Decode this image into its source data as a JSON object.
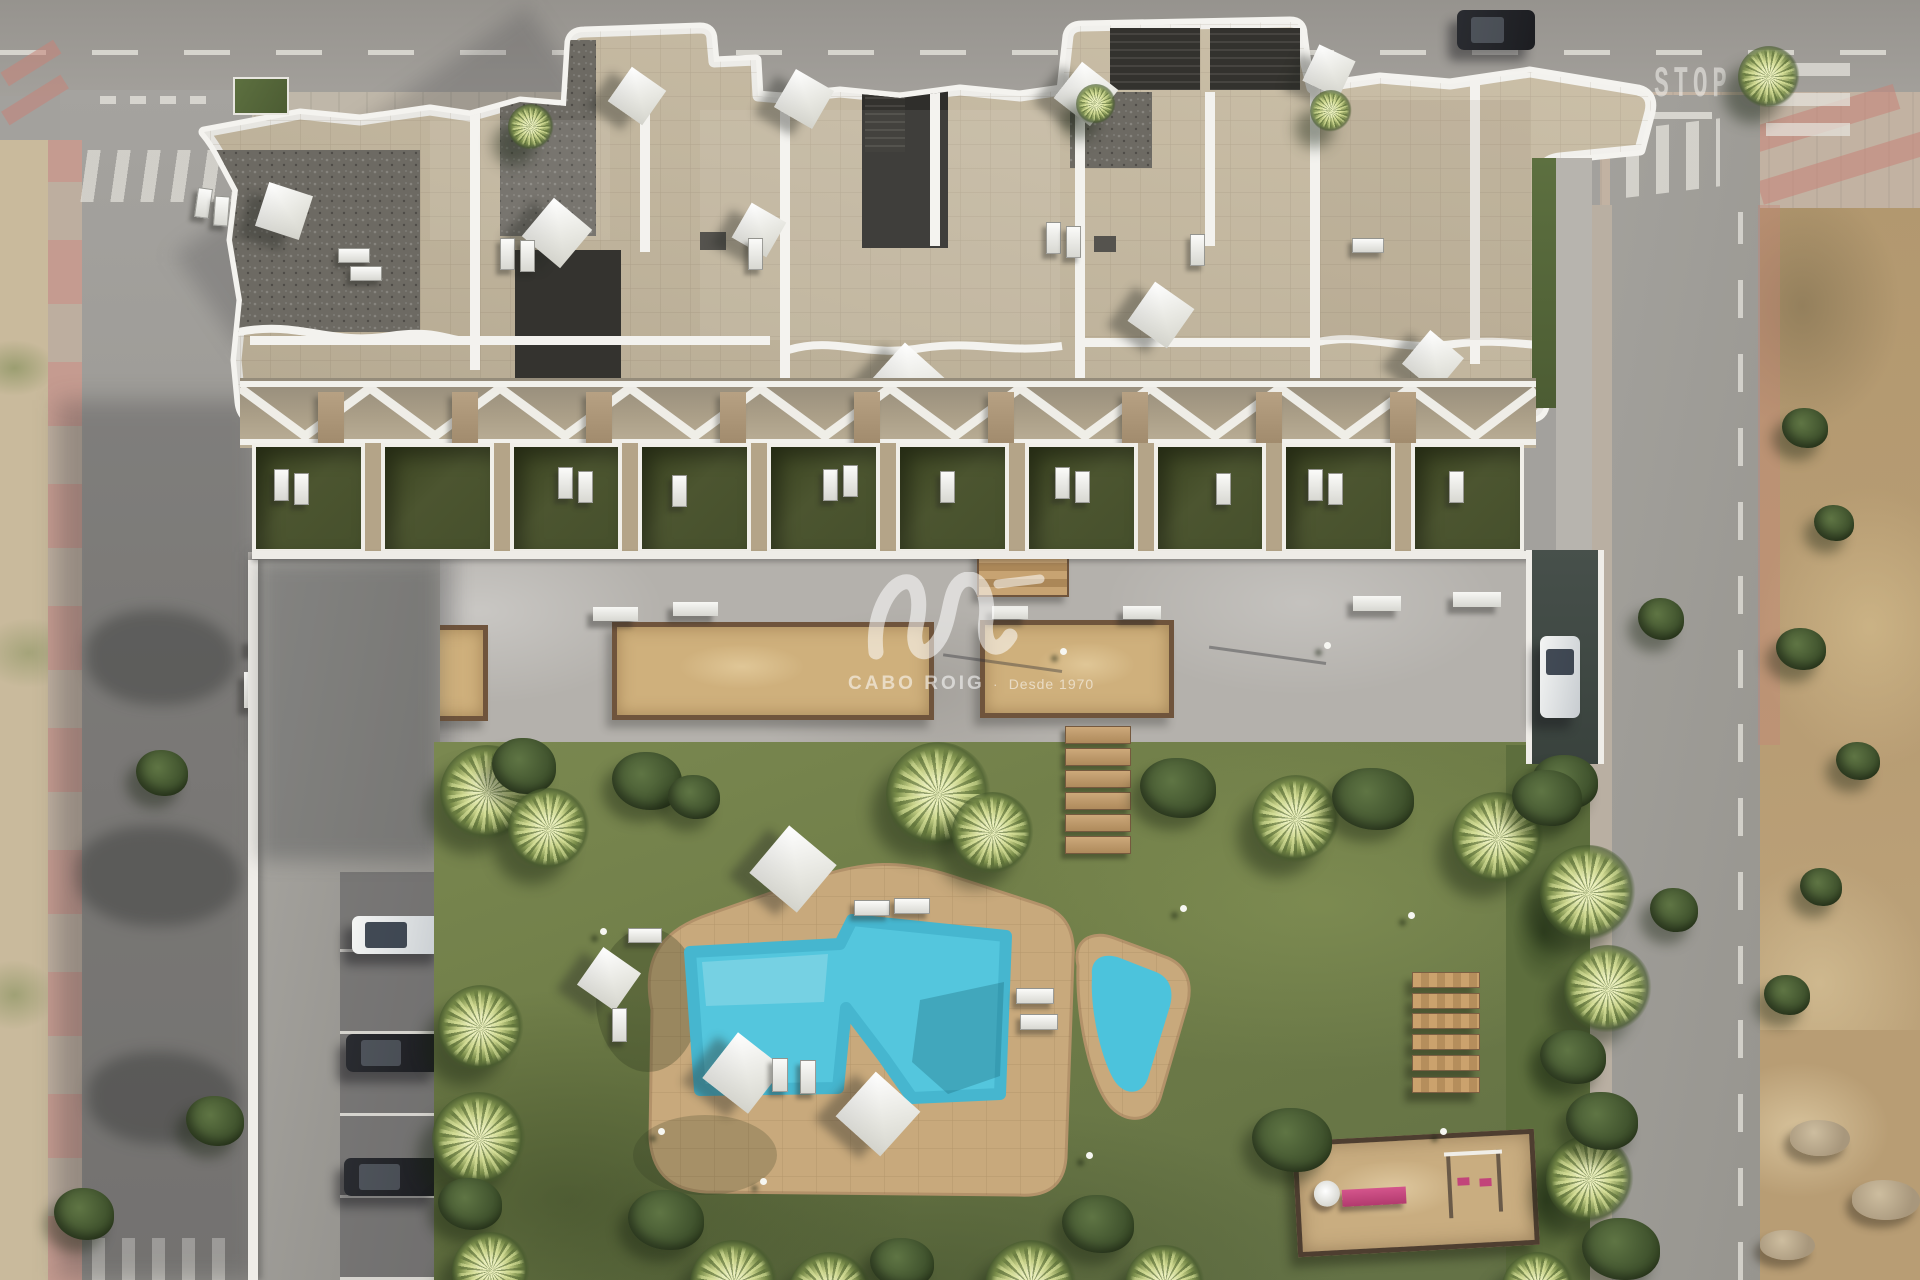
{
  "scene": {
    "type": "aerial-architectural-render",
    "description": "Top-down 3D render of a modern white apartment complex: rooftop terraces with shade sails and sun loungers, a row of private grass gardens under a zigzag pergola, a concrete plaza with sand planters and benches, a large lawn with a free-form turquoise pool, wooden steps and benches, a children's playground, resident parking with cars, surrounding streets with crosswalks and an undeveloped dirt plot on the right."
  },
  "watermark": {
    "brand": "CABO ROIG",
    "separator": "·",
    "tagline": "Desde 1970"
  },
  "road_markings": {
    "stop_text": "STOP"
  },
  "counts": {
    "shade_sails": 10,
    "plaza_planters": 3,
    "parked_cars_left_bays": 3,
    "lawn_wooden_benches": 6,
    "wooden_steps_planks": 6
  },
  "palette": {
    "asphalt": "#a3a19d",
    "plaza_concrete": "#b5b2ad",
    "roof_tile": "#c6b99f",
    "parapet_white": "#f4f3ef",
    "lawn_green": "#6f7d49",
    "terrace_grass": "#49512f",
    "pool_turquoise": "#54c6dd",
    "deck_sand": "#c8a97c",
    "planter_sand": "#cfb07c",
    "dirt_terrain": "#b49a73",
    "sidewalk_pink": "#c59b90",
    "wood": "#b98e5e",
    "playground_sand": "#c9ad80",
    "slide_pink": "#c2447a"
  }
}
